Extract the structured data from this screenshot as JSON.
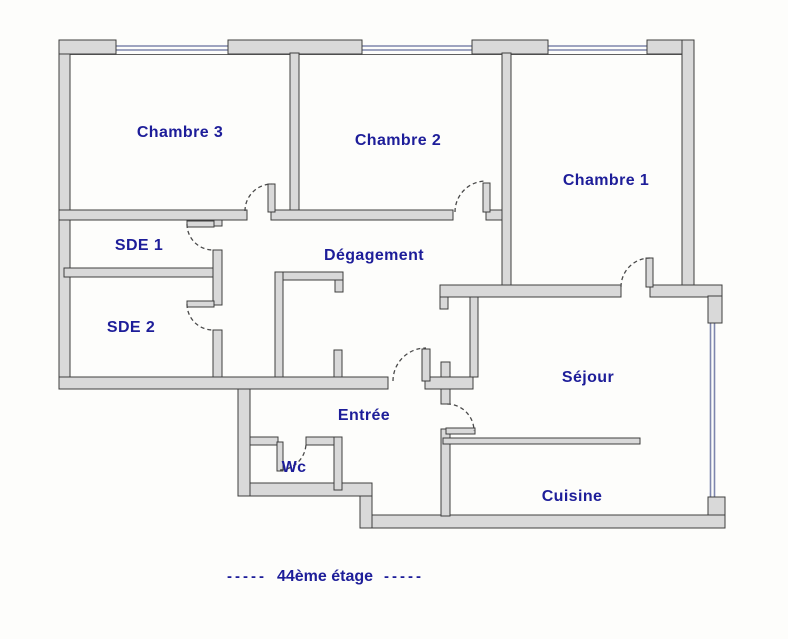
{
  "palette": {
    "wall_fill": "#d9d9d9",
    "wall_stroke": "#3e3e3e",
    "window_color": "#7e86ad",
    "label_color": "#1d1d99",
    "background": "#fdfdfb"
  },
  "plan": {
    "rooms": [
      {
        "label": "Chambre 3"
      },
      {
        "label": "Chambre 2"
      },
      {
        "label": "Chambre 1"
      },
      {
        "label": "SDE 1"
      },
      {
        "label": "SDE 2"
      },
      {
        "label": "Dégagement"
      },
      {
        "label": "Séjour"
      },
      {
        "label": "Entrée"
      },
      {
        "label": "Wc"
      },
      {
        "label": "Cuisine"
      }
    ],
    "caption": {
      "prefix": "-----",
      "label": "44ème étage",
      "suffix": "-----"
    }
  }
}
